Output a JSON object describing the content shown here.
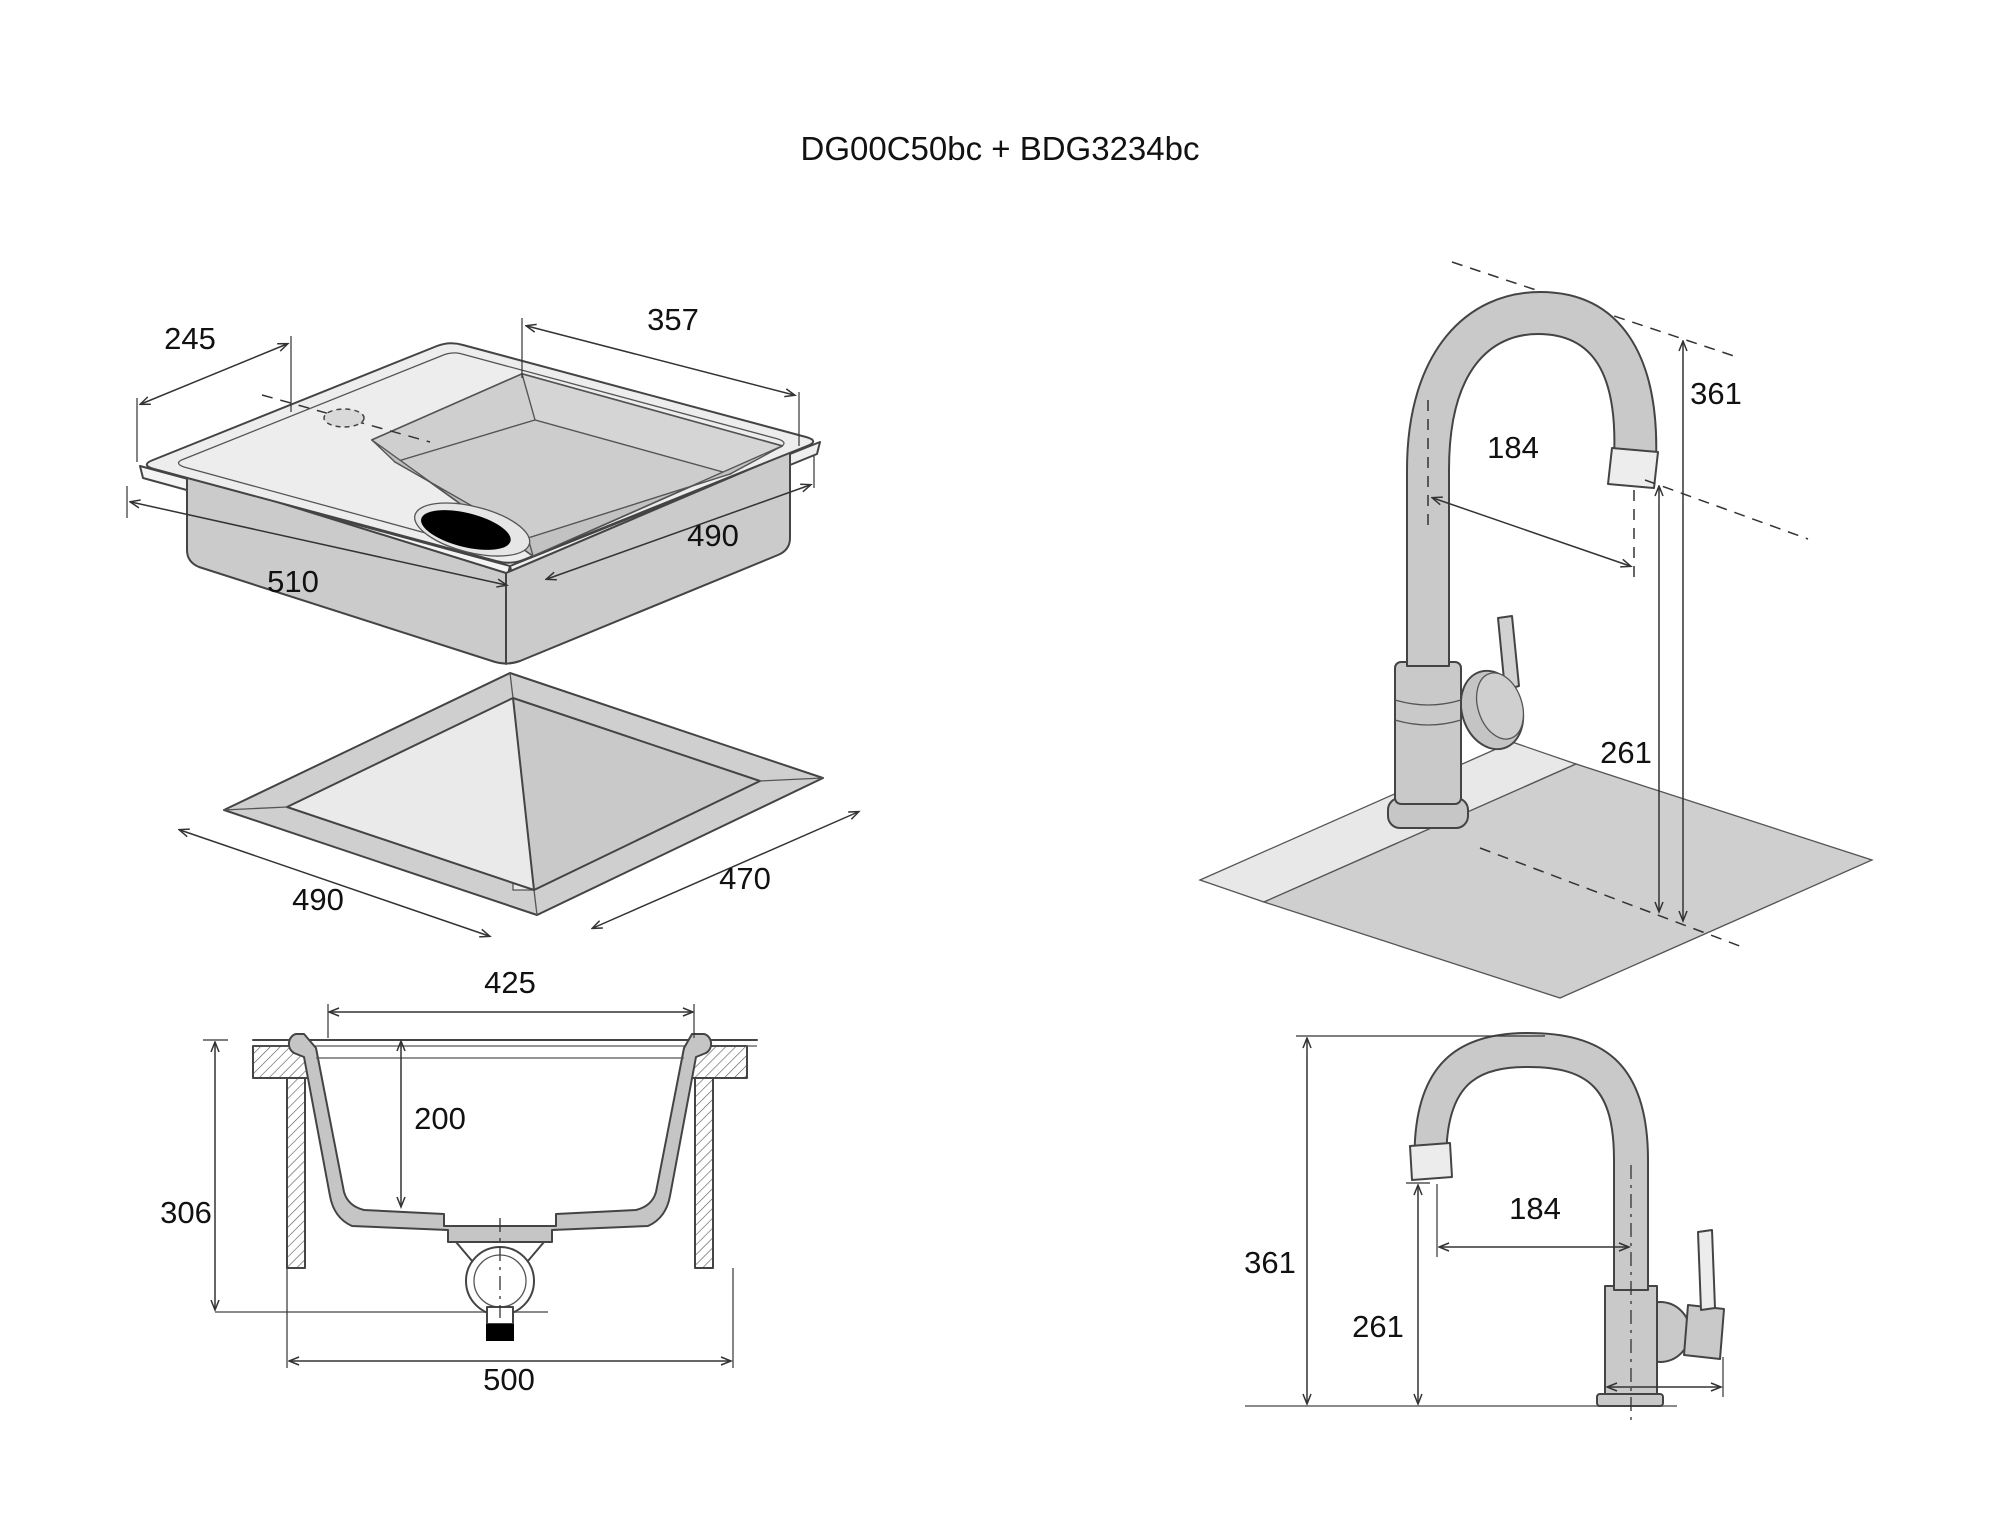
{
  "title": "DG00C50bc + BDG3234bc",
  "panels": {
    "top_left": "sink-isometric-with-cutout",
    "top_right": "faucet-isometric-on-counter",
    "bottom_left": "sink-cross-section",
    "bottom_right": "faucet-side-view"
  },
  "dimensions": [
    {
      "id": "sink-iso-deck-width",
      "value": "245",
      "x": 190,
      "y": 349
    },
    {
      "id": "sink-iso-basin-width",
      "value": "357",
      "x": 673,
      "y": 330
    },
    {
      "id": "sink-iso-length",
      "value": "510",
      "x": 293,
      "y": 592
    },
    {
      "id": "sink-iso-depth-side",
      "value": "490",
      "x": 713,
      "y": 546
    },
    {
      "id": "cutout-width",
      "value": "490",
      "x": 318,
      "y": 910
    },
    {
      "id": "cutout-depth",
      "value": "470",
      "x": 745,
      "y": 889
    },
    {
      "id": "faucet-iso-total-height",
      "value": "361",
      "x": 1716,
      "y": 404
    },
    {
      "id": "faucet-iso-reach",
      "value": "184",
      "x": 1513,
      "y": 458
    },
    {
      "id": "faucet-iso-spout-height",
      "value": "261",
      "x": 1626,
      "y": 763
    },
    {
      "id": "section-bowl-top-width",
      "value": "425",
      "x": 510,
      "y": 993
    },
    {
      "id": "section-bowl-depth",
      "value": "200",
      "x": 440,
      "y": 1129
    },
    {
      "id": "section-total-height",
      "value": "306",
      "x": 186,
      "y": 1223
    },
    {
      "id": "section-base-width",
      "value": "500",
      "x": 509,
      "y": 1390
    },
    {
      "id": "faucet-side-total-height",
      "value": "361",
      "x": 1270,
      "y": 1273
    },
    {
      "id": "faucet-side-spout-height",
      "value": "261",
      "x": 1378,
      "y": 1337
    },
    {
      "id": "faucet-side-reach",
      "value": "184",
      "x": 1535,
      "y": 1219
    }
  ],
  "colors": {
    "deck_light": "#ededed",
    "body_gray": "#c9c9c9",
    "basin_gray": "#c8c8c8",
    "counter_gray": "#cfcfcf",
    "line": "#444444",
    "drain_black": "#000000"
  }
}
